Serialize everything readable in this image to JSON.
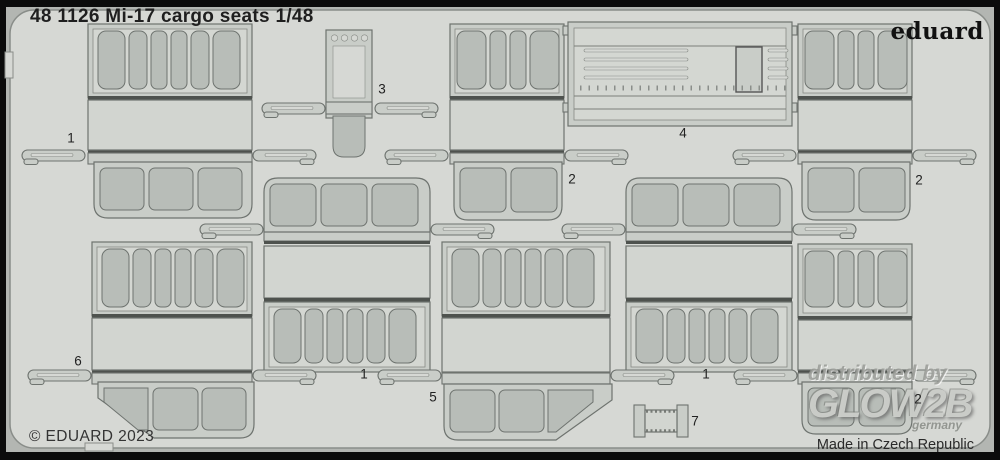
{
  "sheet": {
    "title": "48 1126 Mi-17 cargo seats 1/48",
    "brand": "eduard",
    "copyright": "© EDUARD 2023",
    "made_in": "Made in Czech Republic"
  },
  "watermark": {
    "distributed_by": "distributed by",
    "brand": "GLOW2B",
    "country": "germany"
  },
  "parts": [
    {
      "number": "1"
    },
    {
      "number": "3"
    },
    {
      "number": "2"
    },
    {
      "number": "4"
    },
    {
      "number": "2"
    },
    {
      "number": "6"
    },
    {
      "number": "1"
    },
    {
      "number": "1"
    },
    {
      "number": "5"
    },
    {
      "number": "2"
    },
    {
      "number": "7"
    }
  ],
  "colors": {
    "border": "#0b0b0b",
    "sheet_background": "#d6d8d4",
    "margin": "#b3b6b2",
    "part_fill": "#c9cdc8",
    "panel_fill": "#d2d5d0",
    "seat_fill": "#b8bdb8",
    "outline": "#6e736f",
    "fold_bar": "#4e524e",
    "text": "#1f1f1f"
  }
}
